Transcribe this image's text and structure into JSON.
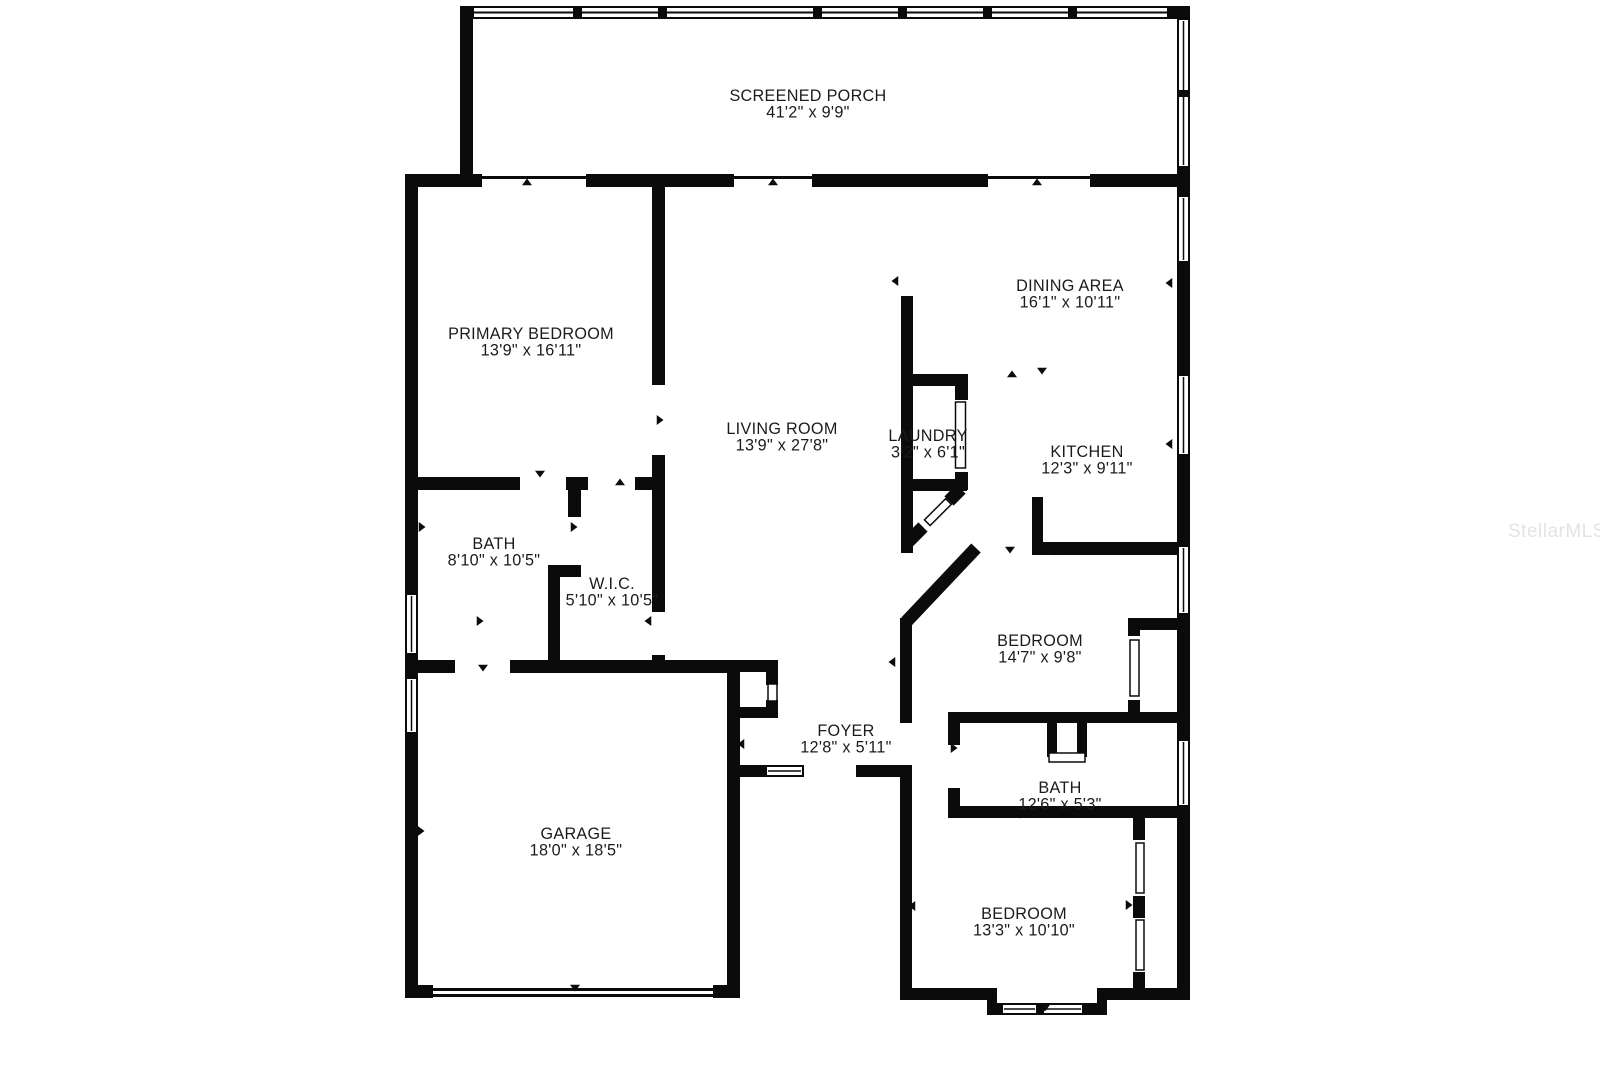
{
  "title": "Floor plan",
  "colors": {
    "wall": "#0b0b0b",
    "background": "#ffffff",
    "label": "#1b1b1b",
    "watermark": "#e3e3e5"
  },
  "watermark": {
    "text": "StellarMLS",
    "x": 1508,
    "y": 537
  },
  "rooms": [
    {
      "name": "screened-porch",
      "label": "SCREENED PORCH",
      "dims": "41'2\" x 9'9\"",
      "x": 808,
      "y": 101
    },
    {
      "name": "primary-bedroom",
      "label": "PRIMARY BEDROOM",
      "dims": "13'9\" x 16'11\"",
      "x": 531,
      "y": 339
    },
    {
      "name": "dining-area",
      "label": "DINING AREA",
      "dims": "16'1\" x 10'11\"",
      "x": 1070,
      "y": 291
    },
    {
      "name": "living-room",
      "label": "LIVING ROOM",
      "dims": "13'9\" x 27'8\"",
      "x": 782,
      "y": 434
    },
    {
      "name": "laundry",
      "label": "LAUNDRY",
      "dims": "3'2\" x 6'1\"",
      "x": 928,
      "y": 441
    },
    {
      "name": "kitchen",
      "label": "KITCHEN",
      "dims": "12'3\" x 9'11\"",
      "x": 1087,
      "y": 457
    },
    {
      "name": "bath-primary",
      "label": "BATH",
      "dims": "8'10\" x 10'5\"",
      "x": 494,
      "y": 549
    },
    {
      "name": "walk-in-closet",
      "label": "W.I.C.",
      "dims": "5'10\" x 10'5\"",
      "x": 612,
      "y": 589
    },
    {
      "name": "bedroom-middle",
      "label": "BEDROOM",
      "dims": "14'7\" x 9'8\"",
      "x": 1040,
      "y": 646
    },
    {
      "name": "foyer",
      "label": "FOYER",
      "dims": "12'8\" x 5'11\"",
      "x": 846,
      "y": 736
    },
    {
      "name": "bath-hall",
      "label": "BATH",
      "dims": "12'6\" x 5'3\"",
      "x": 1060,
      "y": 793
    },
    {
      "name": "garage",
      "label": "GARAGE",
      "dims": "18'0\" x 18'5\"",
      "x": 576,
      "y": 839
    },
    {
      "name": "bedroom-bottom",
      "label": "BEDROOM",
      "dims": "13'3\" x 10'10\"",
      "x": 1024,
      "y": 919
    }
  ],
  "markers": [
    {
      "x": 527,
      "y": 183,
      "d": "up"
    },
    {
      "x": 773,
      "y": 183,
      "d": "up"
    },
    {
      "x": 1037,
      "y": 183,
      "d": "up"
    },
    {
      "x": 413,
      "y": 325,
      "d": "right"
    },
    {
      "x": 659,
      "y": 420,
      "d": "right"
    },
    {
      "x": 896,
      "y": 281,
      "d": "left"
    },
    {
      "x": 1170,
      "y": 283,
      "d": "left"
    },
    {
      "x": 1012,
      "y": 375,
      "d": "up"
    },
    {
      "x": 1042,
      "y": 370,
      "d": "down"
    },
    {
      "x": 930,
      "y": 381,
      "d": "up"
    },
    {
      "x": 930,
      "y": 486,
      "d": "down"
    },
    {
      "x": 1170,
      "y": 444,
      "d": "left"
    },
    {
      "x": 540,
      "y": 473,
      "d": "down"
    },
    {
      "x": 488,
      "y": 487,
      "d": "up"
    },
    {
      "x": 620,
      "y": 483,
      "d": "up"
    },
    {
      "x": 421,
      "y": 527,
      "d": "right"
    },
    {
      "x": 573,
      "y": 527,
      "d": "right"
    },
    {
      "x": 479,
      "y": 621,
      "d": "right"
    },
    {
      "x": 649,
      "y": 621,
      "d": "left"
    },
    {
      "x": 1010,
      "y": 549,
      "d": "down"
    },
    {
      "x": 1056,
      "y": 551,
      "d": "down"
    },
    {
      "x": 893,
      "y": 662,
      "d": "left"
    },
    {
      "x": 483,
      "y": 667,
      "d": "down"
    },
    {
      "x": 742,
      "y": 744,
      "d": "left"
    },
    {
      "x": 953,
      "y": 748,
      "d": "right"
    },
    {
      "x": 1020,
      "y": 814,
      "d": "down"
    },
    {
      "x": 420,
      "y": 831,
      "d": "right"
    },
    {
      "x": 735,
      "y": 831,
      "d": "left"
    },
    {
      "x": 575,
      "y": 987,
      "d": "down"
    },
    {
      "x": 913,
      "y": 906,
      "d": "left"
    },
    {
      "x": 1128,
      "y": 905,
      "d": "right"
    },
    {
      "x": 1045,
      "y": 1007,
      "d": "down"
    }
  ]
}
